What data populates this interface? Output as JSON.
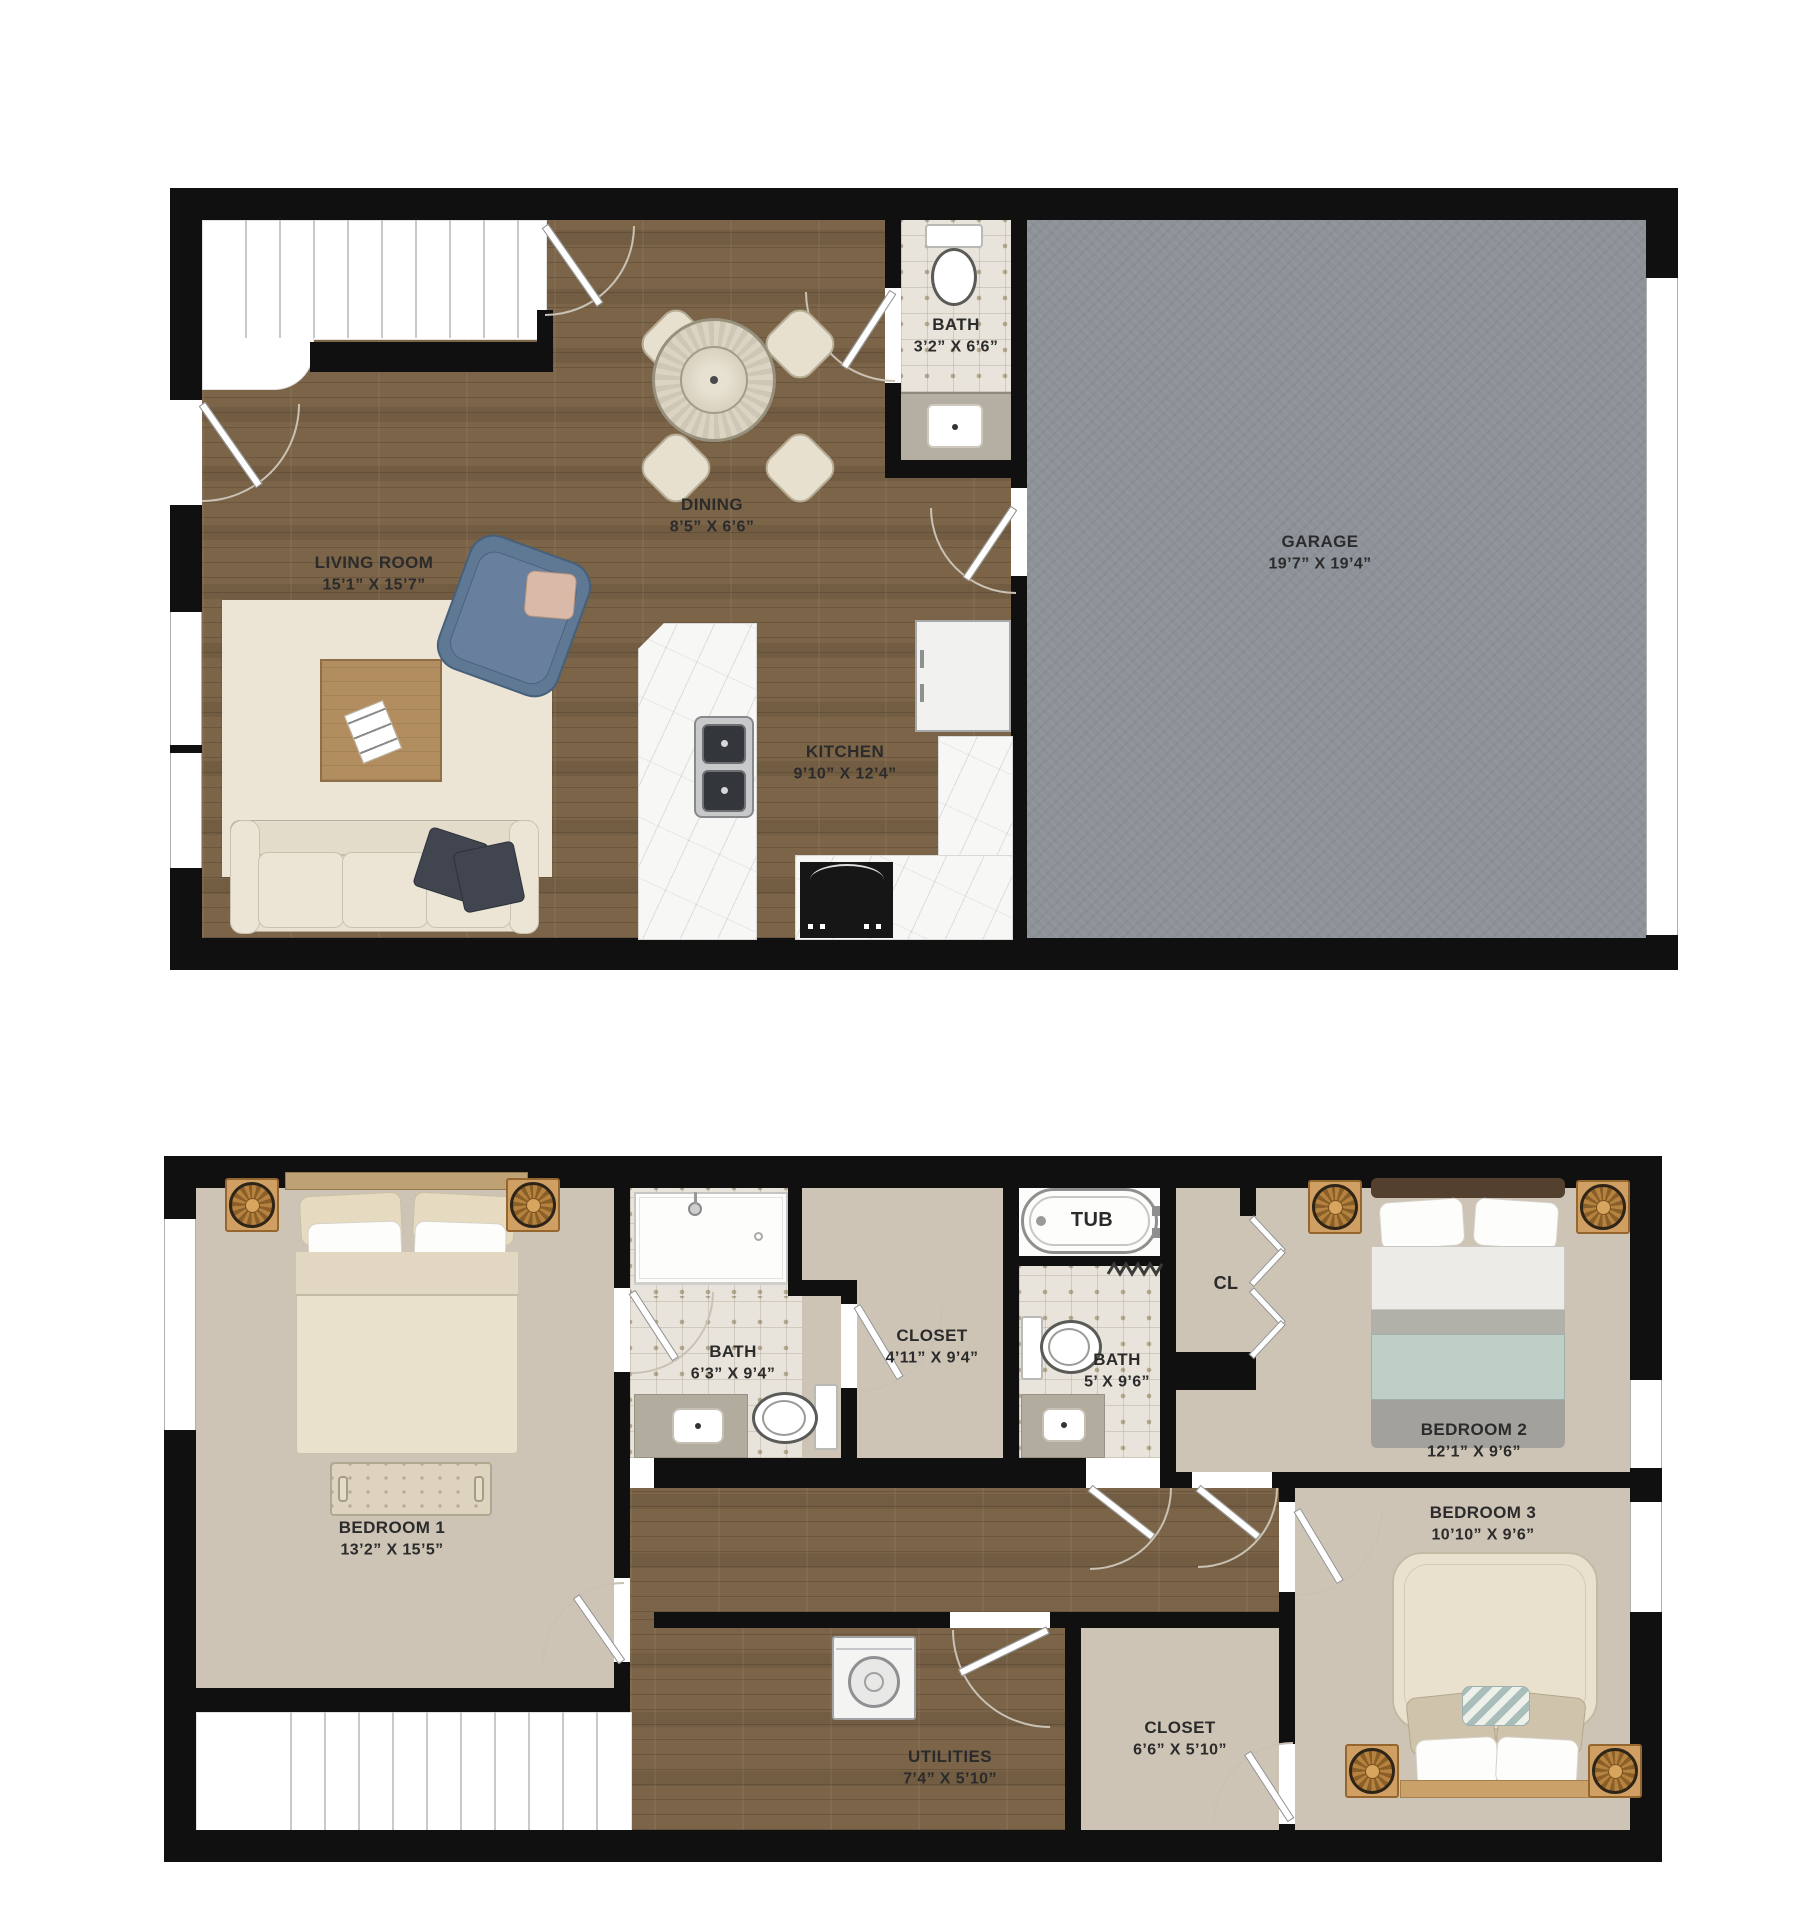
{
  "title": "Two-story townhome floor plan",
  "colors": {
    "wall": "#101010",
    "wood": "#7b6448",
    "garage": "#8c9298",
    "tile": "#e8e4db",
    "tile_dot": "#b3a78f",
    "carpet": "#cdc4b6",
    "rug": "#ece5d6",
    "marble": "#f7f7f5",
    "sofa": "#e9e1d1",
    "pillow_dark": "#40454f",
    "chair_blue": "#68809d",
    "table_wood": "#b18d60",
    "nightstand": "#cf9f63",
    "teal_blanket": "#becfc8",
    "label": "#2b2b2b"
  },
  "floor1": {
    "rooms": {
      "living": {
        "name": "LIVING ROOM",
        "dims": "15’1” X 15’7”"
      },
      "dining": {
        "name": "DINING",
        "dims": "8’5” X 6’6”"
      },
      "bath": {
        "name": "BATH",
        "dims": "3’2” X 6’6”"
      },
      "kitchen": {
        "name": "KITCHEN",
        "dims": "9’10” X 12’4”"
      },
      "garage": {
        "name": "GARAGE",
        "dims": "19’7” X 19’4”"
      }
    }
  },
  "floor2": {
    "rooms": {
      "bedroom1": {
        "name": "BEDROOM 1",
        "dims": "13’2” X 15’5”"
      },
      "bath_main": {
        "name": "BATH",
        "dims": "6’3” X 9’4”"
      },
      "closet_main": {
        "name": "CLOSET",
        "dims": "4’11” X 9’4”"
      },
      "bath_hall": {
        "name": "BATH",
        "dims": "5’ X 9’6”"
      },
      "tub": {
        "name": "TUB"
      },
      "cl": {
        "name": "CL"
      },
      "bedroom2": {
        "name": "BEDROOM 2",
        "dims": "12’1” X 9’6”"
      },
      "bedroom3": {
        "name": "BEDROOM 3",
        "dims": "10’10” X 9’6”"
      },
      "utilities": {
        "name": "UTILITIES",
        "dims": "7’4” X 5’10”"
      },
      "closet_hall": {
        "name": "CLOSET",
        "dims": "6’6” X 5’10”"
      }
    }
  }
}
